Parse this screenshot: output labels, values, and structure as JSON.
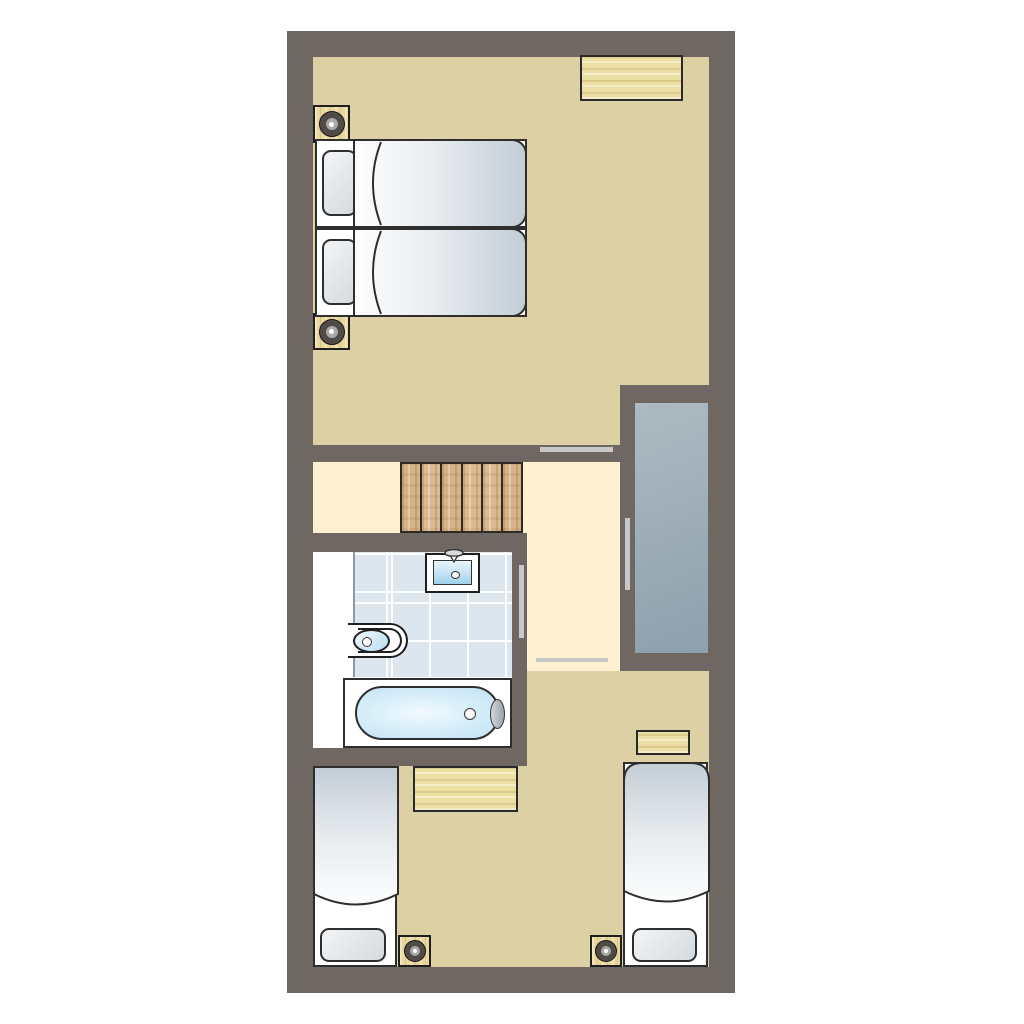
{
  "title": "apartment-floor-plan",
  "palette": {
    "bg": "#ffffff",
    "wall": "#6f6762",
    "floor_tan": "#dcd0a4",
    "floor_cream": "#fdf1d2",
    "wood_light": "#ecdfa4",
    "wood_stair": "#d7b389",
    "wood_night": "#e9d79d",
    "tile": "#dce6ee",
    "void_from": "#aebac2",
    "void_to": "#8da0ad",
    "duvet_light": "#fcfdfe",
    "duvet_dark": "#c3cdd6",
    "pillow_light": "#f3f5f7",
    "pillow_dark": "#d4dade",
    "water_light": "#f2fafe",
    "water_mid": "#bfe2f4",
    "line": "#2e2e2e",
    "door_bar": "#c8c8c8"
  },
  "plan": {
    "rooms": [
      {
        "name": "bedroom-top",
        "floor": "tan",
        "furniture": [
          "desk",
          "nightstand-with-lamp",
          "nightstand-with-lamp",
          "twin-bed",
          "twin-bed"
        ]
      },
      {
        "name": "stair-landing",
        "floor": "cream",
        "furniture": [
          "staircase-6-treads"
        ]
      },
      {
        "name": "hallway",
        "floor": "cream",
        "furniture": []
      },
      {
        "name": "void-shaft",
        "floor": "gray",
        "furniture": []
      },
      {
        "name": "bathroom",
        "floor": "white-and-blue-tile",
        "furniture": [
          "washbasin",
          "toilet",
          "bathtub"
        ]
      },
      {
        "name": "bedroom-bottom",
        "floor": "tan",
        "furniture": [
          "desk",
          "side-table",
          "nightstand-with-lamp",
          "nightstand-with-lamp",
          "twin-bed",
          "twin-bed"
        ]
      }
    ],
    "door_openings": 4,
    "stair_treads": 6,
    "beds_total": 4
  }
}
